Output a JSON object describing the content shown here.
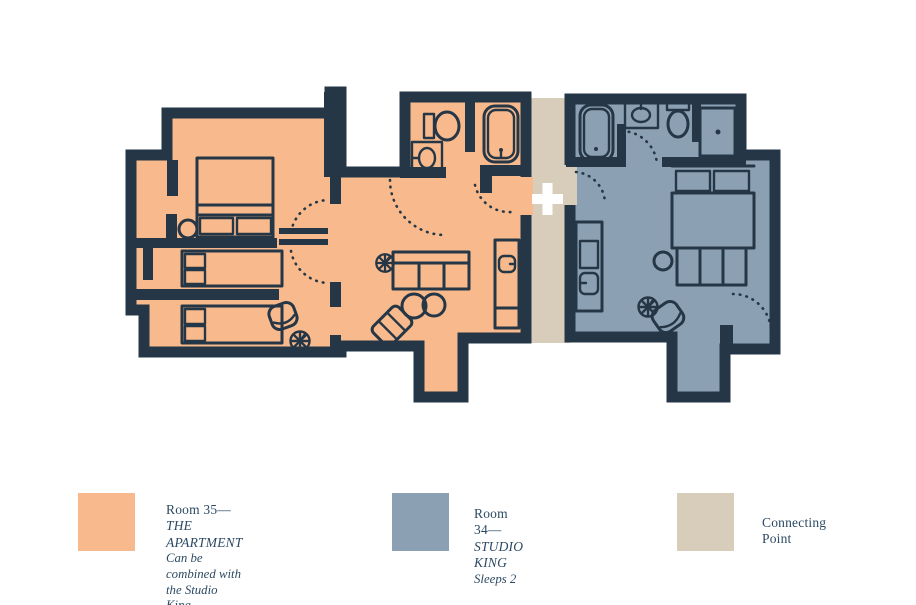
{
  "palette": {
    "room35": "#F8BA8C",
    "room34": "#8CA0B4",
    "connector": "#D8CDBA",
    "walls": "#253746",
    "text": "#2C4A63",
    "background": "#FFFFFF"
  },
  "floor_plan": {
    "connector_symbol": "+",
    "areas": [
      {
        "id": "room-35",
        "fill": "room35"
      },
      {
        "id": "room-34",
        "fill": "room34"
      },
      {
        "id": "connecting-point",
        "fill": "connector"
      }
    ]
  },
  "legend": {
    "items": [
      {
        "swatch": "room35",
        "title_prefix": "Room 35— ",
        "title_emphasis": "THE APARTMENT",
        "lines": [
          "Can be combined with the Studio King",
          "Sleeps 4"
        ]
      },
      {
        "swatch": "room34",
        "title_prefix": "Room 34— ",
        "title_emphasis": "STUDIO KING",
        "lines": [
          "Sleeps 2"
        ]
      },
      {
        "swatch": "connector",
        "title_prefix": "Connecting Point",
        "title_emphasis": "",
        "lines": []
      }
    ]
  }
}
